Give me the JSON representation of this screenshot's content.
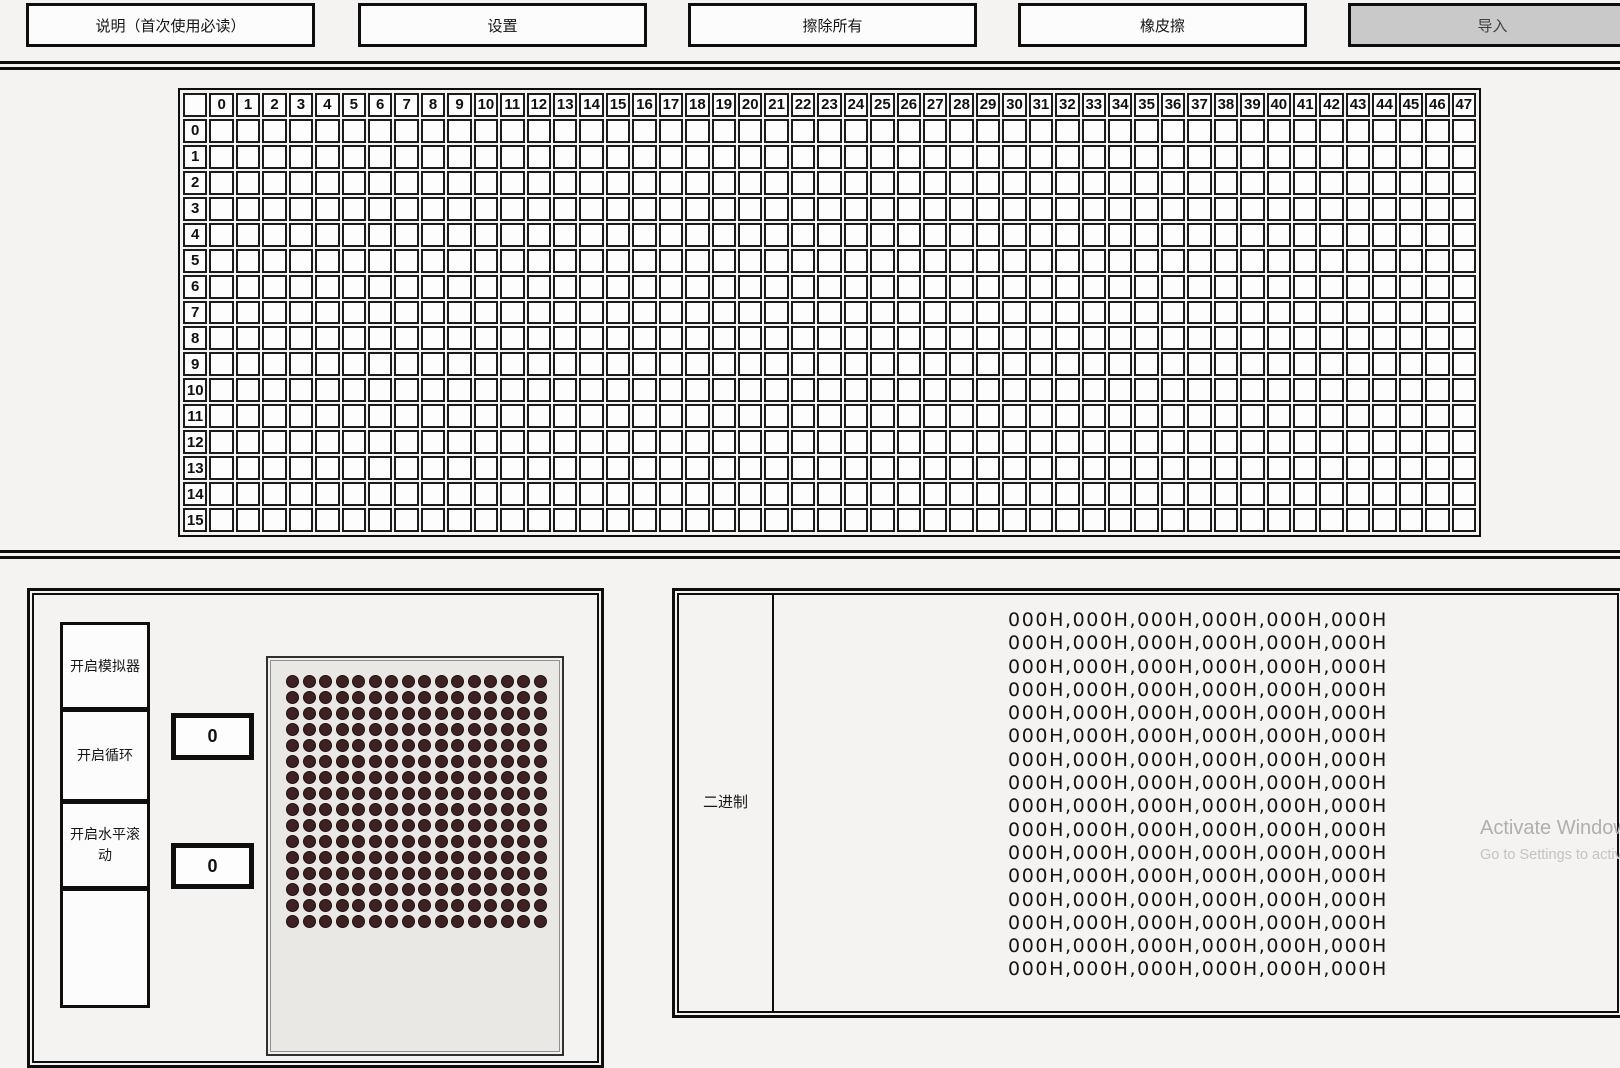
{
  "toolbar": {
    "buttons": [
      {
        "label": "说明（首次使用必读）",
        "state": "normal"
      },
      {
        "label": "设置",
        "state": "normal"
      },
      {
        "label": "擦除所有",
        "state": "normal"
      },
      {
        "label": "橡皮擦",
        "state": "normal"
      },
      {
        "label": "导入",
        "state": "active"
      }
    ]
  },
  "grid": {
    "col_headers": [
      "0",
      "1",
      "2",
      "3",
      "4",
      "5",
      "6",
      "7",
      "8",
      "9",
      "10",
      "11",
      "12",
      "13",
      "14",
      "15",
      "16",
      "17",
      "18",
      "19",
      "20",
      "21",
      "22",
      "23",
      "24",
      "25",
      "26",
      "27",
      "28",
      "29",
      "30",
      "31",
      "32",
      "33",
      "34",
      "35",
      "36",
      "37",
      "38",
      "39",
      "40",
      "41",
      "42",
      "43",
      "44",
      "45",
      "46",
      "47"
    ],
    "row_headers": [
      "0",
      "1",
      "2",
      "3",
      "4",
      "5",
      "6",
      "7",
      "8",
      "9",
      "10",
      "11",
      "12",
      "13",
      "14",
      "15"
    ],
    "cols": 48,
    "rows": 16
  },
  "simulator": {
    "buttons": [
      {
        "label": "开启模拟器"
      },
      {
        "label": "开启循环"
      },
      {
        "label": "开启水平滚动"
      },
      {
        "label": ""
      }
    ],
    "value_boxes": [
      "0",
      "0"
    ],
    "led": {
      "cols": 16,
      "rows": 16,
      "dot_color": "#3e2222",
      "panel_color": "#e9e8e5"
    }
  },
  "binary": {
    "label": "二进制",
    "lines": [
      "000H,000H,000H,000H,000H,000H",
      "000H,000H,000H,000H,000H,000H",
      "000H,000H,000H,000H,000H,000H",
      "000H,000H,000H,000H,000H,000H",
      "000H,000H,000H,000H,000H,000H",
      "000H,000H,000H,000H,000H,000H",
      "000H,000H,000H,000H,000H,000H",
      "000H,000H,000H,000H,000H,000H",
      "000H,000H,000H,000H,000H,000H",
      "000H,000H,000H,000H,000H,000H",
      "000H,000H,000H,000H,000H,000H",
      "000H,000H,000H,000H,000H,000H",
      "000H,000H,000H,000H,000H,000H",
      "000H,000H,000H,000H,000H,000H",
      "000H,000H,000H,000H,000H,000H",
      "000H,000H,000H,000H,000H,000H"
    ]
  },
  "watermark": {
    "line1": "Activate Windows",
    "line2": "Go to Settings to activate Windows."
  },
  "colors": {
    "page_background": "#f4f3f1",
    "border": "#0e0e0e",
    "import_button_background": "#c9c9c9",
    "led_dot": "#3e2222",
    "led_panel": "#e9e8e5",
    "watermark_gray": "#b1aeae"
  }
}
